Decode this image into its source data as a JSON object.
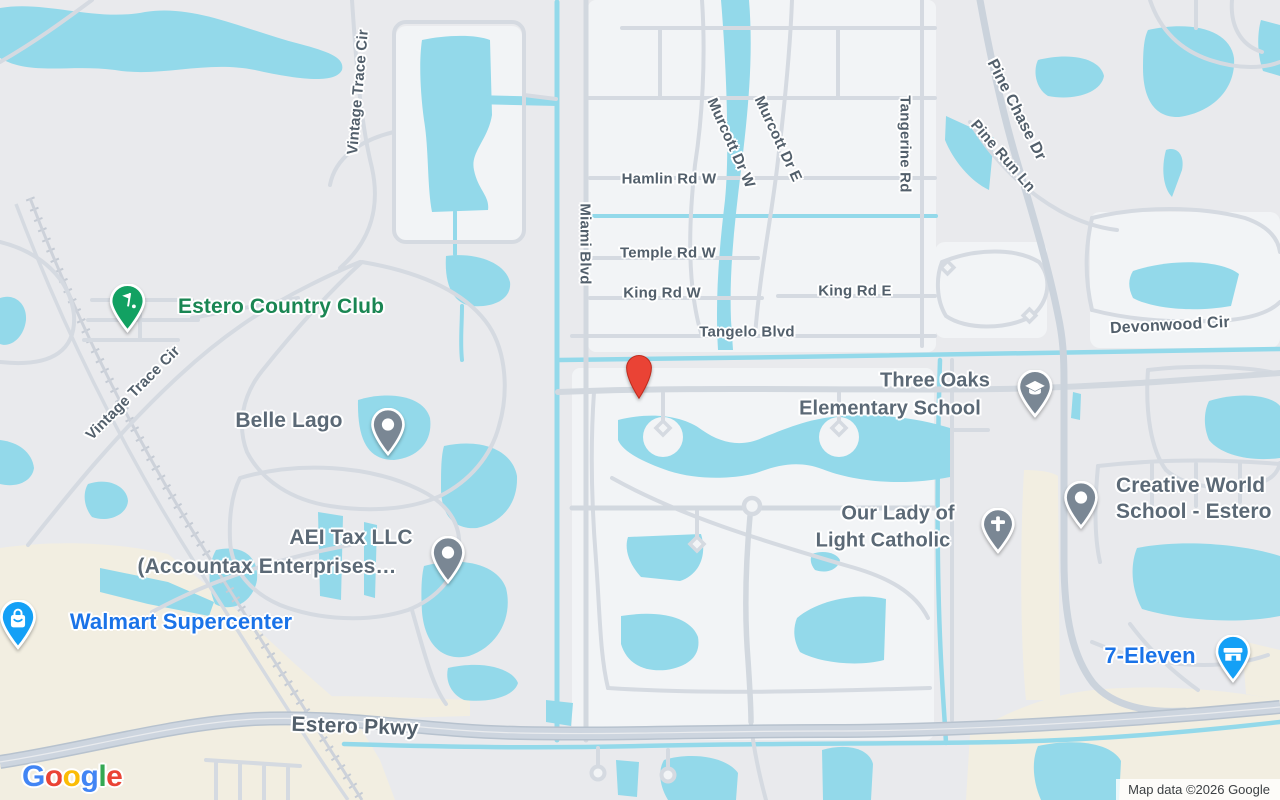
{
  "attribution": "Map data ©2026 Google",
  "logo": {
    "letters": [
      {
        "ch": "G",
        "style": "color:#4285F4"
      },
      {
        "ch": "o",
        "style": "color:#EA4335"
      },
      {
        "ch": "o",
        "style": "color:#FBBC05"
      },
      {
        "ch": "g",
        "style": "color:#4285F4"
      },
      {
        "ch": "l",
        "style": "color:#34A853"
      },
      {
        "ch": "e",
        "style": "color:#EA4335"
      }
    ]
  },
  "road_labels": [
    {
      "id": "vintage-trace-cir-north",
      "text": "Vintage Trace Cir"
    },
    {
      "id": "vintage-trace-cir-west",
      "text": "Vintage Trace Cir"
    },
    {
      "id": "miami-blvd",
      "text": "Miami Blvd"
    },
    {
      "id": "hamlin-rd-w",
      "text": "Hamlin Rd W"
    },
    {
      "id": "temple-rd-w",
      "text": "Temple Rd W"
    },
    {
      "id": "king-rd-w",
      "text": "King Rd W"
    },
    {
      "id": "king-rd-e",
      "text": "King Rd E"
    },
    {
      "id": "tangelo-blvd",
      "text": "Tangelo Blvd"
    },
    {
      "id": "murcott-dr-w",
      "text": "Murcott Dr W"
    },
    {
      "id": "murcott-dr-e",
      "text": "Murcott Dr E"
    },
    {
      "id": "tangerine-rd",
      "text": "Tangerine Rd"
    },
    {
      "id": "pine-chase-dr",
      "text": "Pine Chase Dr"
    },
    {
      "id": "pine-run-ln",
      "text": "Pine Run Ln"
    },
    {
      "id": "devonwood-cir",
      "text": "Devonwood Cir"
    },
    {
      "id": "estero-pkwy",
      "text": "Estero Pkwy"
    }
  ],
  "pois": [
    {
      "id": "estero-country-club",
      "category": "golf-club",
      "lines": [
        "Estero Country Club"
      ]
    },
    {
      "id": "belle-lago",
      "category": "neighborhood",
      "lines": [
        "Belle Lago"
      ]
    },
    {
      "id": "aei-tax-llc",
      "category": "business",
      "lines": [
        "AEI Tax LLC",
        "(Accountax Enterprises…"
      ]
    },
    {
      "id": "walmart-supercenter",
      "category": "department-store",
      "lines": [
        "Walmart Supercenter"
      ]
    },
    {
      "id": "three-oaks-elementary-school",
      "category": "school",
      "lines": [
        "Three Oaks",
        "Elementary School"
      ]
    },
    {
      "id": "our-lady-of-light-catholic",
      "category": "church",
      "lines": [
        "Our Lady of",
        "Light Catholic"
      ]
    },
    {
      "id": "creative-world-school",
      "category": "school",
      "lines": [
        "Creative World",
        "School - Estero"
      ]
    },
    {
      "id": "seven-eleven",
      "category": "convenience-store",
      "lines": [
        "7-Eleven"
      ]
    }
  ],
  "marker": {
    "id": "destination-marker",
    "color": "#EA4335"
  },
  "colors": {
    "land": "#E9EAED",
    "residential_block": "#F2F4F6",
    "commercial_area": "#F2EEE1",
    "water": "#93D9EA",
    "road_minor": "#D5DAE1",
    "road_major": "#CBD3DC",
    "highway_fill": "#CDD5DF",
    "highway_casing": "#B7C2CE",
    "railroad": "#C5CBD4",
    "road_label_text": "#525F6B",
    "poi_label_slate": "#5B6976",
    "poi_label_green": "#1A8653",
    "poi_label_blue": "#1A73E8",
    "pin_slate": "#7A8794",
    "pin_green": "#12A162",
    "pin_blue": "#14A0F6",
    "marker_red": "#EA4335"
  }
}
